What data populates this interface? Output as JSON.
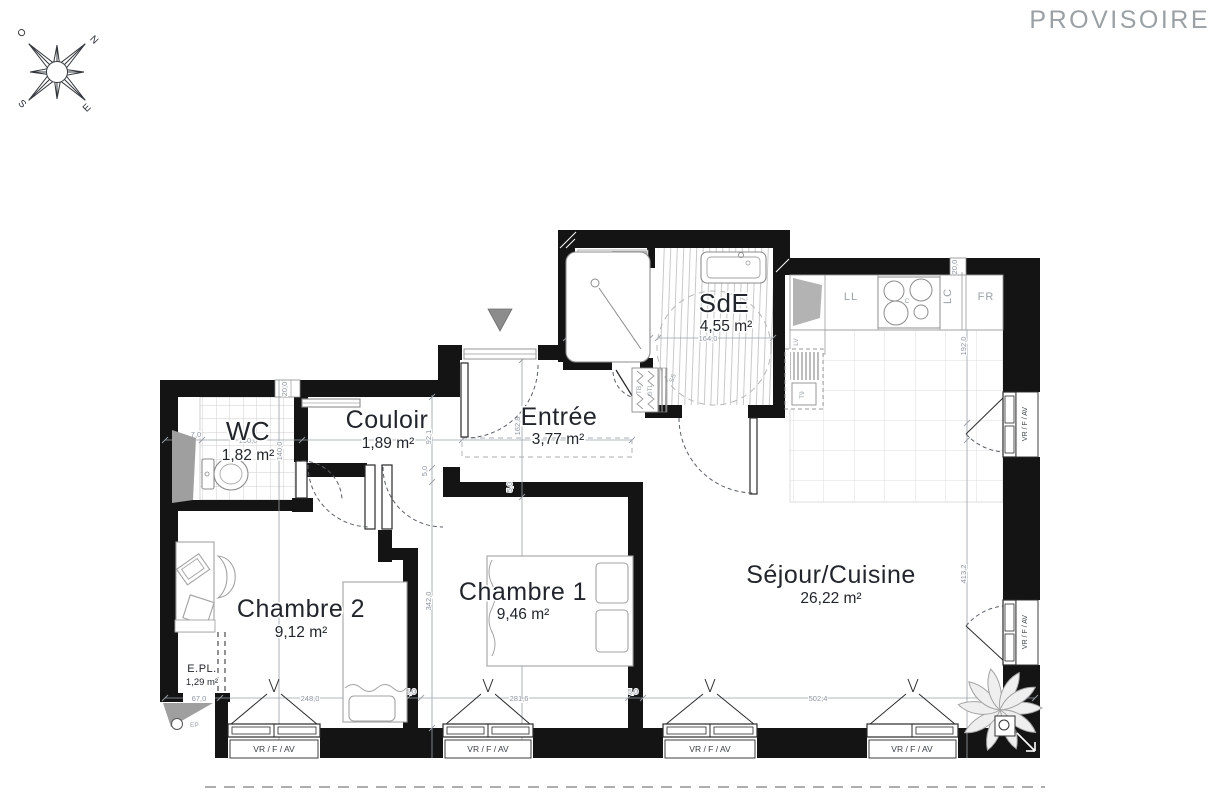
{
  "banner": {
    "text": "PROVISOIRE"
  },
  "compass": {
    "n": "N",
    "s": "S",
    "e": "E",
    "o": "O"
  },
  "rooms": {
    "wc": {
      "name": "WC",
      "area": "1,82 m²"
    },
    "couloir": {
      "name": "Couloir",
      "area": "1,89 m²"
    },
    "entree": {
      "name": "Entrée",
      "area": "3,77 m²"
    },
    "sde": {
      "name": "SdE",
      "area": "4,55 m²"
    },
    "chambre2": {
      "name": "Chambre 2",
      "area": "9,12 m²"
    },
    "chambre1": {
      "name": "Chambre 1",
      "area": "9,46 m²"
    },
    "sejour": {
      "name": "Séjour/Cuisine",
      "area": "26,22 m²"
    },
    "epl": {
      "name": "E.PL.",
      "area": "1,29 m²"
    }
  },
  "labels": {
    "ll": "LL",
    "lc": "LC",
    "fr": "FR",
    "c": "C",
    "lv": "LV",
    "t9": "T9",
    "ss": "SS",
    "ep": "EP",
    "gtl": "GTL",
    "tb": "TB",
    "window": "VR / F / AV"
  },
  "dims": {
    "d7_0": "7,0",
    "d130_0": "130,0",
    "d140_0": "140,0",
    "d20_0": "20,0",
    "d92_1": "92,1",
    "d5_0": "5,0",
    "d342_0": "342,0",
    "d162_8": "162,8",
    "d92_0": "92,0",
    "d164_0": "164,0",
    "d192_0": "192,0",
    "d413_2": "413,2",
    "d67_0": "67,0",
    "d248_0": "248,0",
    "d281_6": "281,6",
    "d502_4": "502,4"
  },
  "colors": {
    "wall": "#141414",
    "dim": "#8e94a0",
    "banner": "#9aa0a4",
    "accentGray": "#9f9f9f"
  }
}
